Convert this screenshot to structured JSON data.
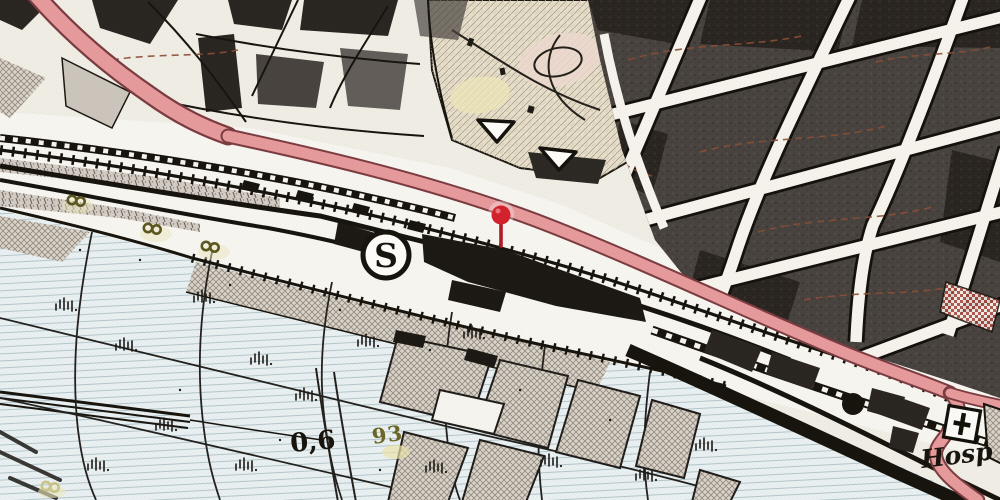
{
  "map": {
    "station": {
      "symbol": "S"
    },
    "labels": {
      "hospital": "Hosp",
      "elevation": "0,6",
      "vegetation": "93"
    },
    "marker": {
      "kind": "location-pin",
      "x": 501,
      "y": 215
    },
    "icons": [
      "location-pin-icon",
      "sbahn-station-icon",
      "hospital-cross-icon",
      "railway-track",
      "marsh-symbol",
      "tree-symbol"
    ]
  },
  "colors": {
    "paper": "#f0ede5",
    "ink": "#17130d",
    "building": "#494340",
    "building-dark": "#2a2521",
    "road-fill": "#e69a9c",
    "road-casing": "#7b3c40",
    "meadow": "#e9f0f2",
    "meadow-line": "#b4c6ca",
    "pin": "#d3222b",
    "pin-stem": "#b01c23",
    "olive": "#6b6526",
    "park": "#e7dfca",
    "hatch": "#dad4cb"
  }
}
